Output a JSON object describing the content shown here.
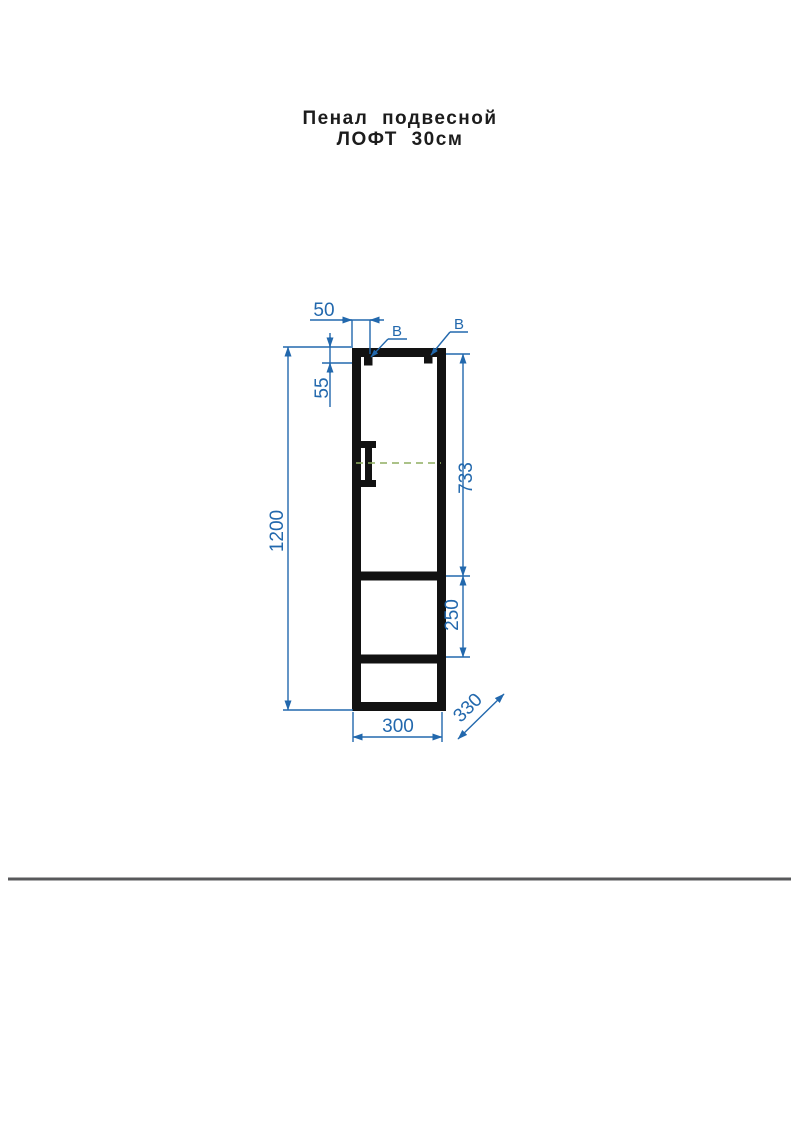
{
  "title": {
    "line1": "Пенал подвесной",
    "line2": "ЛОФТ 30см"
  },
  "drawing": {
    "type": "furniture front elevation",
    "dimensions_mm": {
      "mount_side_offset": "50",
      "mount_top_offset": "55",
      "overall_height": "1200",
      "door_section_height": "733",
      "middle_section_height": "250",
      "overall_width": "300",
      "depth": "330"
    },
    "mount_points": {
      "left_label": "В",
      "right_label": "В"
    },
    "colors": {
      "dimension_blue": "#2268ad",
      "outline_black": "#121212",
      "centerline_green": "#8fae60",
      "divider_gray": "#58595b"
    }
  }
}
